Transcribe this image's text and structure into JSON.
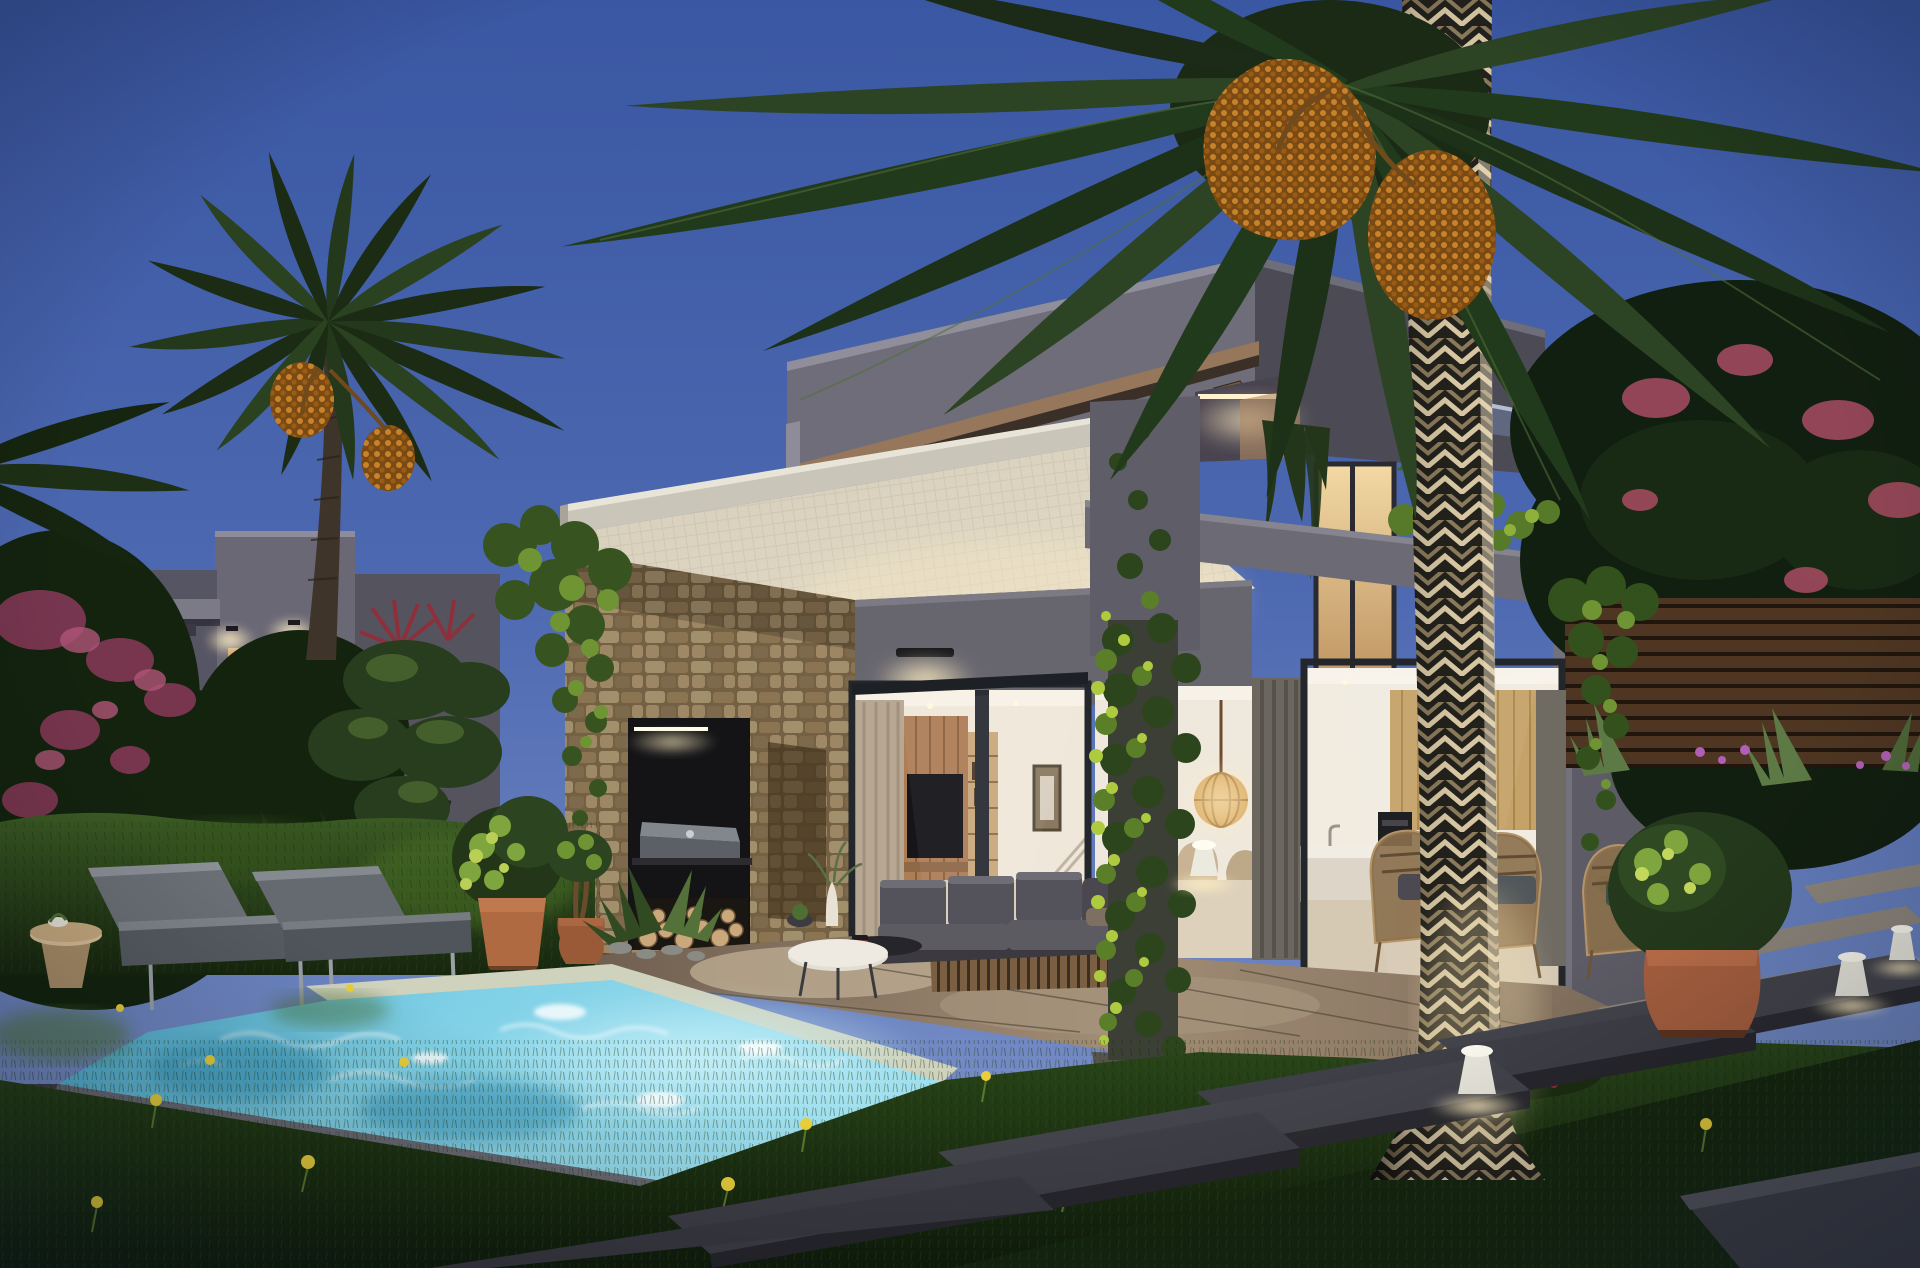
{
  "scene": {
    "description": "Photorealistic architectural rendering of a modern concrete villa at dusk with illuminated interior, swimming pool, palm trees and landscaped garden",
    "time_of_day": "dusk",
    "image_width_px": 1920,
    "image_height_px": 1268
  },
  "palette": {
    "sky_top": "#3a57a3",
    "sky_mid": "#4c68b0",
    "sky_low": "#6e86c2",
    "sky_horizon": "#8496ca",
    "concrete": "#6e6d79",
    "concrete_dark": "#4c4b55",
    "concrete_deep": "#3f3e48",
    "pergola_wood": "#8a6f55",
    "canopy_soffit": "#d9d2c0",
    "canopy_warm": "#efe2c8",
    "stone_wall": "#b79c73",
    "warm_window": "#e3bc82",
    "interior_wall": "#efe7da",
    "tv_black": "#15151a",
    "wood_tvwall": "#ad7d56",
    "curtain_beige": "#b7a894",
    "curtain_grey": "#6b675f",
    "pool_deep": "#49a8cc",
    "pool_bright": "#9fdfee",
    "coping_light": "#cfd2bd",
    "coping_dark": "#3f3f49",
    "grass": "#223a14",
    "grass_dark": "#0f1c0a",
    "hedge": "#2c451c",
    "palm_green": "#2c4424",
    "palm_dark": "#1b2b17",
    "trunk_base": "#23211c",
    "trunk_light": "#d6c6a2",
    "dates_orange": "#c8832a",
    "terracotta": "#b06a42",
    "ivy_bright": "#aecb40",
    "ivy_mid": "#5a7f28",
    "sofa_grey": "#4a484e",
    "lounger_grey": "#5e6468",
    "paver_dark": "#3a3a40",
    "paver_light": "#8d867c",
    "bollard_white": "#eceadf",
    "blossom_red": "#a04a5e",
    "fence_wood": "#6b4a30"
  },
  "objects": [
    {
      "name": "sky",
      "label": "Clear dusk sky gradient"
    },
    {
      "name": "main-villa",
      "label": "Two-storey grey concrete villa with cantilevered upper box"
    },
    {
      "name": "pergola-beams",
      "label": "Timber pergola beams on upper roof ledge"
    },
    {
      "name": "white-canopy",
      "label": "Light canopy soffit over ground-floor terrace"
    },
    {
      "name": "stone-wing",
      "label": "Dry-stone clad wing with outdoor kitchen niche"
    },
    {
      "name": "bbq-niche",
      "label": "Black BBQ niche with grill, LED strip and firewood store"
    },
    {
      "name": "living-room-glazing",
      "label": "Sliding glass doors revealing lit living room with TV wall"
    },
    {
      "name": "kitchen-glazing",
      "label": "Glass wall revealing lit kitchen with wood cabinetry and island"
    },
    {
      "name": "pendant-lamp",
      "label": "Woven sphere pendant lamp in dining area"
    },
    {
      "name": "ivy-column",
      "label": "Vine-covered concrete column at terrace"
    },
    {
      "name": "foreground-palm",
      "label": "Tall date palm with diamond-cut trunk and fruit clusters"
    },
    {
      "name": "left-palm",
      "label": "Second date palm on the left with orange date clusters"
    },
    {
      "name": "background-villa",
      "label": "Neighbouring flat-roof villa with lit porch"
    },
    {
      "name": "bougainvillea",
      "label": "Dark foliage with pink bougainvillea blossoms on the left"
    },
    {
      "name": "hedge",
      "label": "Clipped garden hedge behind the sun loungers"
    },
    {
      "name": "sun-loungers",
      "label": "Two grey poolside chaise lounges with steel legs"
    },
    {
      "name": "side-table",
      "label": "Round timber side table beside loungers"
    },
    {
      "name": "terracotta-pots",
      "label": "Terracotta pots with clipped shrubs and twisted topiary"
    },
    {
      "name": "outdoor-sofa",
      "label": "Charcoal outdoor sofa with timber slat base and coffee tables"
    },
    {
      "name": "rattan-chairs",
      "label": "Rattan armchairs on the terrace by the kitchen"
    },
    {
      "name": "swimming-pool",
      "label": "Turquoise mosaic pool with light coping and dark border"
    },
    {
      "name": "lawn",
      "label": "Dark evening lawn with dandelions"
    },
    {
      "name": "stepping-stones",
      "label": "Large dark stone planks crossing the lawn"
    },
    {
      "name": "bollard-lights",
      "label": "White conical garden bollard lights"
    },
    {
      "name": "timber-fence",
      "label": "Horizontal timber fence with agaves and flowers at right"
    },
    {
      "name": "flowering-tree",
      "label": "Dark tree with red blossoms on the right"
    }
  ]
}
